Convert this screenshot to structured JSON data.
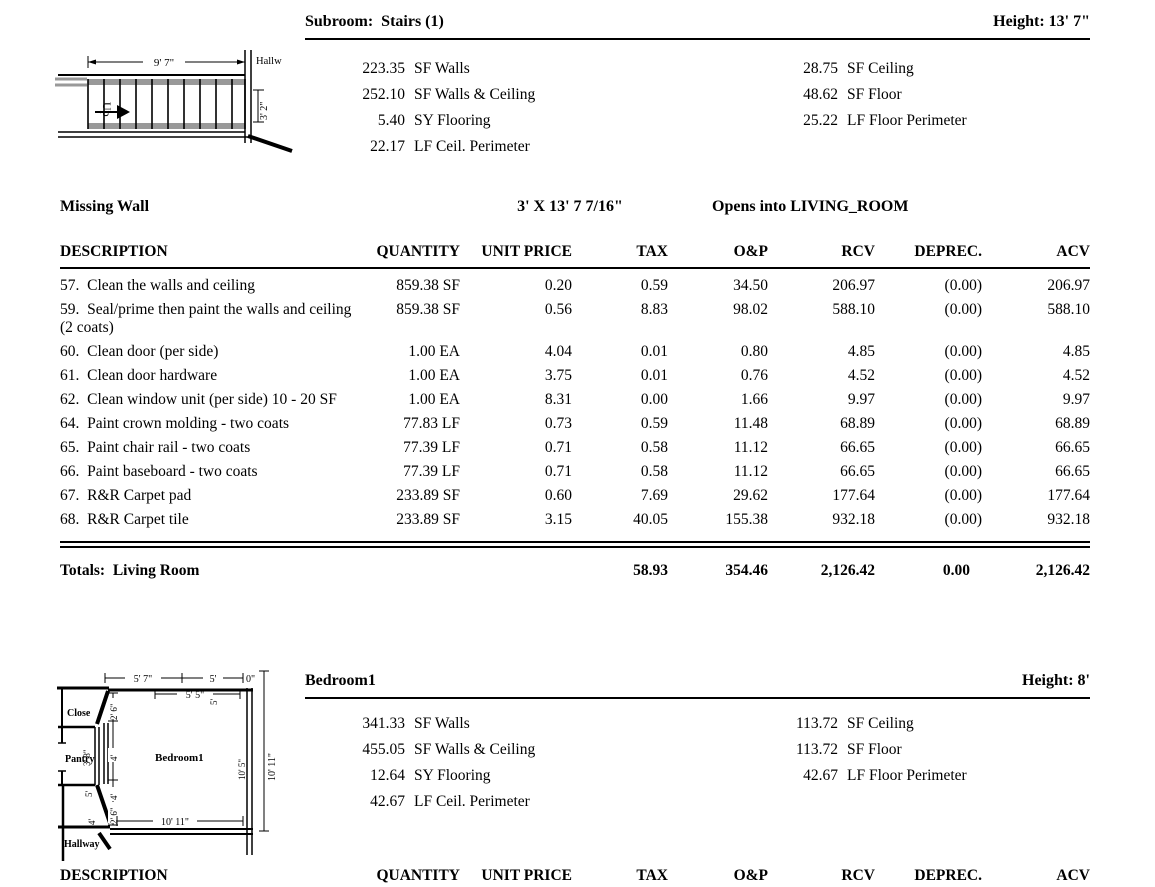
{
  "sections": {
    "stairs": {
      "title": "Subroom:  Stairs (1)",
      "height": "Height: 13' 7\"",
      "measurements_left": [
        {
          "value": "223.35",
          "label": "SF Walls"
        },
        {
          "value": "252.10",
          "label": "SF Walls & Ceiling"
        },
        {
          "value": "5.40",
          "label": "SY Flooring"
        },
        {
          "value": "22.17",
          "label": "LF Ceil. Perimeter"
        }
      ],
      "measurements_right": [
        {
          "value": "28.75",
          "label": "SF Ceiling"
        },
        {
          "value": "48.62",
          "label": "SF Floor"
        },
        {
          "value": "25.22",
          "label": "LF Floor Perimeter"
        }
      ],
      "missing_wall": {
        "label": "Missing Wall",
        "size": "3' X 13' 7 7/16\"",
        "opens_into": "Opens into LIVING_ROOM"
      },
      "diagram": {
        "width_dim": "9' 7\"",
        "height_dim": "3' 2\"",
        "up": "Up",
        "hallway": "Hallw"
      }
    },
    "bedroom": {
      "title": "Bedroom1",
      "height": "Height: 8'",
      "measurements_left": [
        {
          "value": "341.33",
          "label": "SF Walls"
        },
        {
          "value": "455.05",
          "label": "SF Walls & Ceiling"
        },
        {
          "value": "12.64",
          "label": "SY Flooring"
        },
        {
          "value": "42.67",
          "label": "LF Ceil. Perimeter"
        }
      ],
      "measurements_right": [
        {
          "value": "113.72",
          "label": "SF Ceiling"
        },
        {
          "value": "113.72",
          "label": "SF Floor"
        },
        {
          "value": "42.67",
          "label": "LF Floor Perimeter"
        }
      ],
      "diagram": {
        "rooms": {
          "closet": "Close",
          "pantry": "Pantry",
          "bedroom": "Bedroom1",
          "hallway": "Hallway"
        },
        "dims": {
          "top1": "5' 7\"",
          "top2": "5'",
          "top3": "0\"",
          "top4": "5' 5\"",
          "inner1": "2' 6\"",
          "inner2": "4'",
          "inner3": "4'",
          "inner4": "2' 6\"",
          "pantry_right": "3' 8\"",
          "lower_left": "5'",
          "hall": "4'",
          "bottom": "10' 11\"",
          "right_inner": "10' 5\"",
          "right_outer": "10' 11\"",
          "top_right": "5'"
        }
      }
    }
  },
  "table": {
    "headers": [
      "DESCRIPTION",
      "QUANTITY",
      "UNIT PRICE",
      "TAX",
      "O&P",
      "RCV",
      "DEPREC.",
      "ACV"
    ],
    "rows": [
      {
        "desc": "57.  Clean the walls and ceiling",
        "qty": "859.38 SF",
        "unit": "0.20",
        "tax": "0.59",
        "op": "34.50",
        "rcv": "206.97",
        "dep": "(0.00)",
        "acv": "206.97"
      },
      {
        "desc": "59.  Seal/prime then paint the walls and ceiling (2 coats)",
        "qty": "859.38 SF",
        "unit": "0.56",
        "tax": "8.83",
        "op": "98.02",
        "rcv": "588.10",
        "dep": "(0.00)",
        "acv": "588.10"
      },
      {
        "desc": "60.  Clean door (per side)",
        "qty": "1.00 EA",
        "unit": "4.04",
        "tax": "0.01",
        "op": "0.80",
        "rcv": "4.85",
        "dep": "(0.00)",
        "acv": "4.85"
      },
      {
        "desc": "61.  Clean door hardware",
        "qty": "1.00 EA",
        "unit": "3.75",
        "tax": "0.01",
        "op": "0.76",
        "rcv": "4.52",
        "dep": "(0.00)",
        "acv": "4.52"
      },
      {
        "desc": "62.  Clean window unit (per side) 10 - 20 SF",
        "qty": "1.00 EA",
        "unit": "8.31",
        "tax": "0.00",
        "op": "1.66",
        "rcv": "9.97",
        "dep": "(0.00)",
        "acv": "9.97"
      },
      {
        "desc": "64.  Paint crown molding - two coats",
        "qty": "77.83 LF",
        "unit": "0.73",
        "tax": "0.59",
        "op": "11.48",
        "rcv": "68.89",
        "dep": "(0.00)",
        "acv": "68.89"
      },
      {
        "desc": "65.  Paint chair rail - two coats",
        "qty": "77.39 LF",
        "unit": "0.71",
        "tax": "0.58",
        "op": "11.12",
        "rcv": "66.65",
        "dep": "(0.00)",
        "acv": "66.65"
      },
      {
        "desc": "66.  Paint baseboard - two coats",
        "qty": "77.39 LF",
        "unit": "0.71",
        "tax": "0.58",
        "op": "11.12",
        "rcv": "66.65",
        "dep": "(0.00)",
        "acv": "66.65"
      },
      {
        "desc": "67.  R&R Carpet pad",
        "qty": "233.89 SF",
        "unit": "0.60",
        "tax": "7.69",
        "op": "29.62",
        "rcv": "177.64",
        "dep": "(0.00)",
        "acv": "177.64"
      },
      {
        "desc": "68.  R&R Carpet tile",
        "qty": "233.89 SF",
        "unit": "3.15",
        "tax": "40.05",
        "op": "155.38",
        "rcv": "932.18",
        "dep": "(0.00)",
        "acv": "932.18"
      }
    ],
    "totals": {
      "label": "Totals:  Living Room",
      "tax": "58.93",
      "op": "354.46",
      "rcv": "2,126.42",
      "dep": "0.00",
      "acv": "2,126.42"
    }
  }
}
